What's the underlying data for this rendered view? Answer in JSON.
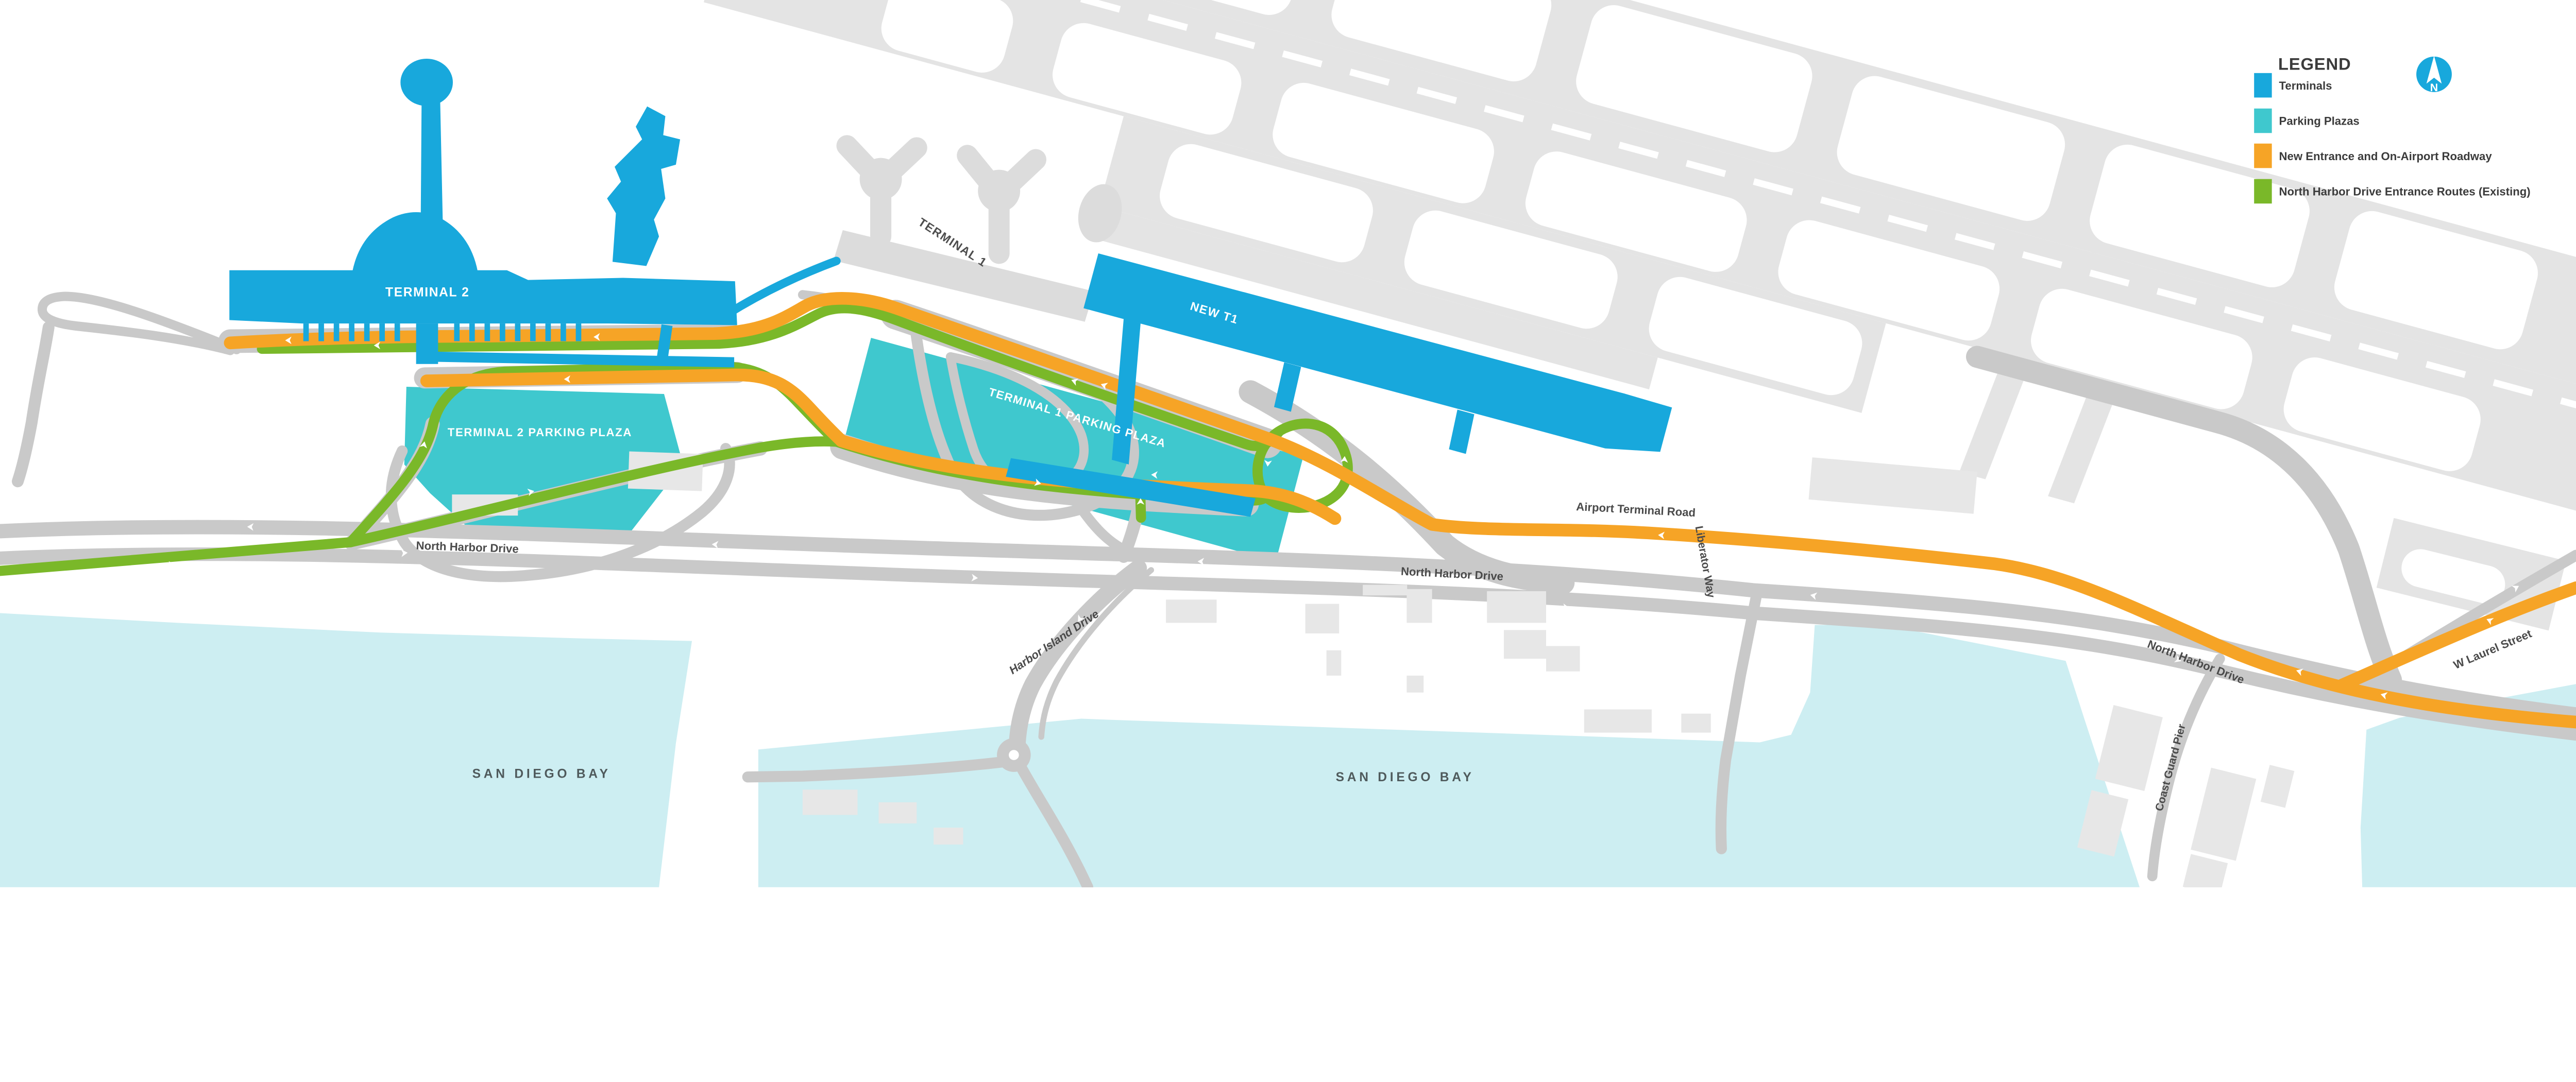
{
  "legend": {
    "title": "LEGEND",
    "items": [
      {
        "label": "Terminals",
        "color": "#18A8DC"
      },
      {
        "label": "Parking Plazas",
        "color": "#3FC8CE"
      },
      {
        "label": "New Entrance and On-Airport Roadway",
        "color": "#F6A426"
      },
      {
        "label": "North Harbor Drive Entrance Routes (Existing)",
        "color": "#7AB829"
      }
    ],
    "compass_label": "N"
  },
  "labels": {
    "terminal_2": "TERMINAL 2",
    "terminal_1": "TERMINAL 1",
    "new_t1": "NEW T1",
    "terminal_2_parking_plaza": "TERMINAL 2 PARKING PLAZA",
    "terminal_1_parking_plaza": "TERMINAL 1 PARKING PLAZA",
    "airport_terminal_road": "Airport Terminal Road",
    "north_harbor_drive": "North Harbor Drive",
    "harbor_island_drive": "Harbor Island Drive",
    "liberator_way": "Liberator Way",
    "w_laurel_street": "W Laurel Street",
    "coast_guard_pier": "Coast Guard Pier",
    "san_diego_bay": "SAN DIEGO BAY"
  },
  "colors": {
    "terminal_blue": "#18A8DC",
    "parking_teal": "#3FC8CE",
    "new_roadway_orange": "#F6A426",
    "existing_route_green": "#7AB829",
    "road_gray": "#C9C9C9",
    "airfield_gray": "#E4E4E4",
    "building_gray": "#E7E7E7",
    "existing_terminal_gray": "#DCDCDC",
    "water_blue": "#CDEEF2",
    "background": "#FFFFFF"
  }
}
